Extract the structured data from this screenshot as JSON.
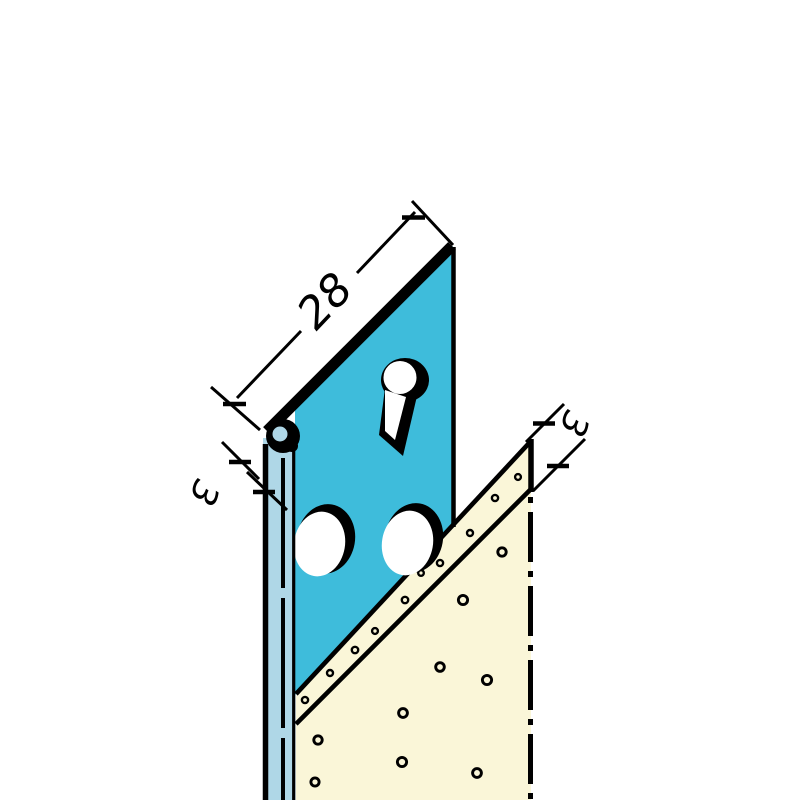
{
  "labels": {
    "profile_width": "28",
    "fold_thickness": "3",
    "edge_setback": "3"
  },
  "colors": {
    "background": "#FFFFFF",
    "profile_face": "#3EBCDB",
    "profile_side": "#AFD7E7",
    "panel": "#FAF6D8",
    "hole": "#FFFFFF",
    "line": "#000000"
  }
}
